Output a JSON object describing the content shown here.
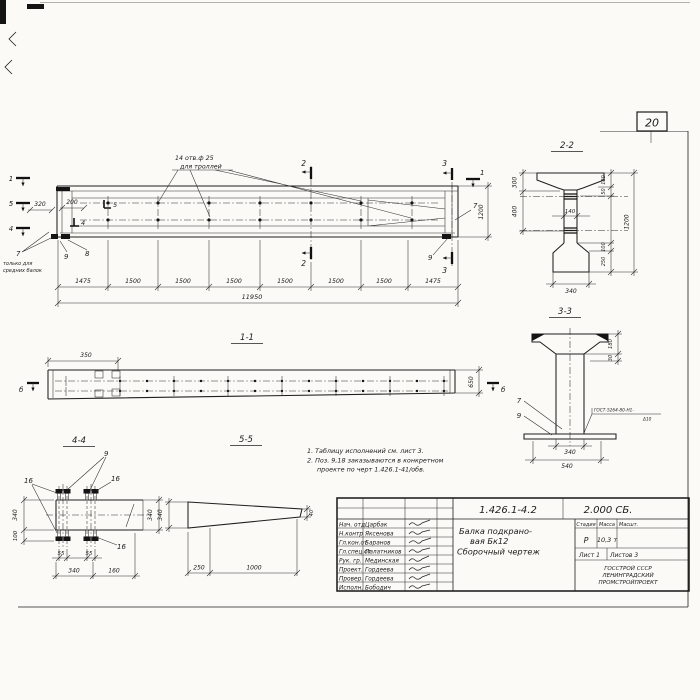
{
  "sheet": {
    "page_number": "20"
  },
  "elevation": {
    "holes_note_line1": "14 отв.ф 25",
    "holes_note_line2": "для троллей",
    "cut_1_left": "1",
    "cut_5_left": "5",
    "cut_4_left": "4",
    "cut_2_top": "2",
    "cut_2_bottom": "2",
    "cut_3_top": "3",
    "cut_3_bottom": "3",
    "cut_1_right": "1",
    "pos_5": "5",
    "pos_4": "4",
    "pos_7_left": "7",
    "pos_8": "8",
    "pos_9_left": "9",
    "pos_7_right": "7",
    "pos_9_right": "9",
    "only_note_line1": "только для",
    "only_note_line2": "средних балок",
    "dim_320": "320",
    "dim_200": "200",
    "dim_1200": "1200",
    "dim_chain": [
      "1475",
      "1500",
      "1500",
      "1500",
      "1500",
      "1500",
      "1500",
      "1475"
    ],
    "dim_total": "11950"
  },
  "section22": {
    "title": "2-2",
    "dim_300": "300",
    "dim_400": "400",
    "dim_140": "140",
    "dim_180": "180",
    "dim_50": "50",
    "dim_100": "100",
    "dim_250": "250",
    "dim_1200": "1200",
    "dim_340": "340"
  },
  "section33": {
    "title": "3-3",
    "dim_180": "180",
    "dim_30": "30",
    "pos_7": "7",
    "pos_9": "9",
    "weld_line1": "ГОСТ-5264-80-Н1-",
    "weld_line2": "Δ10",
    "dim_340": "340",
    "dim_540": "540"
  },
  "section11": {
    "title": "1-1",
    "dim_350": "350",
    "dim_650": "650",
    "mark_b_left": "б",
    "mark_b_right": "б"
  },
  "section44": {
    "title": "4-4",
    "pos_9": "9",
    "pos_16_left": "16",
    "pos_16_right": "16",
    "pos_16_bottom": "16",
    "dim_340_left": "340",
    "dim_100": "100",
    "dim_55a": "55",
    "dim_55b": "55",
    "dim_340_bottom": "340",
    "dim_160": "160",
    "dim_340_right": "340"
  },
  "section55": {
    "title": "5-5",
    "dim_340": "340",
    "dim_250": "250",
    "dim_1000": "1000",
    "dim_40": "40"
  },
  "notes": {
    "line1": "1. Таблицу исполнений см. лист 3.",
    "line2": "2. Поз. 9,18 заказываются в конкретном",
    "line3": "проекте по черт 1.426.1-41/обв."
  },
  "title_block": {
    "doc_number": "1.426.1-4.2",
    "doc_code": "2.000 СБ.",
    "product_line1": "Балка подкрано-",
    "product_line2": "вая Бк12",
    "product_line3": "Сборочный чертеж",
    "col_stage": "Стадия",
    "col_mass": "Масса",
    "col_scale": "Масшт.",
    "stage": "Р",
    "mass": "10,3 т",
    "sheet": "Лист 1",
    "sheets": "Листов 3",
    "org_line1": "ГОССТРОЙ СССР",
    "org_line2": "ЛЕНИНГРАДСКИЙ",
    "org_line3": "ПРОМСТРОЙПРОЕКТ",
    "roles": [
      {
        "role": "Нач. отд",
        "name": "Царбак"
      },
      {
        "role": "Н.контр",
        "name": "Яксенова"
      },
      {
        "role": "Гл.кон.от",
        "name": "Баранов"
      },
      {
        "role": "Гл.спец.от",
        "name": "Палатников"
      },
      {
        "role": "Рук. гр.",
        "name": "Мединская"
      },
      {
        "role": "Проект.",
        "name": "Гордеева"
      },
      {
        "role": "Провер.",
        "name": "Гордеева"
      },
      {
        "role": "Исполн.",
        "name": "Бободич"
      }
    ]
  }
}
